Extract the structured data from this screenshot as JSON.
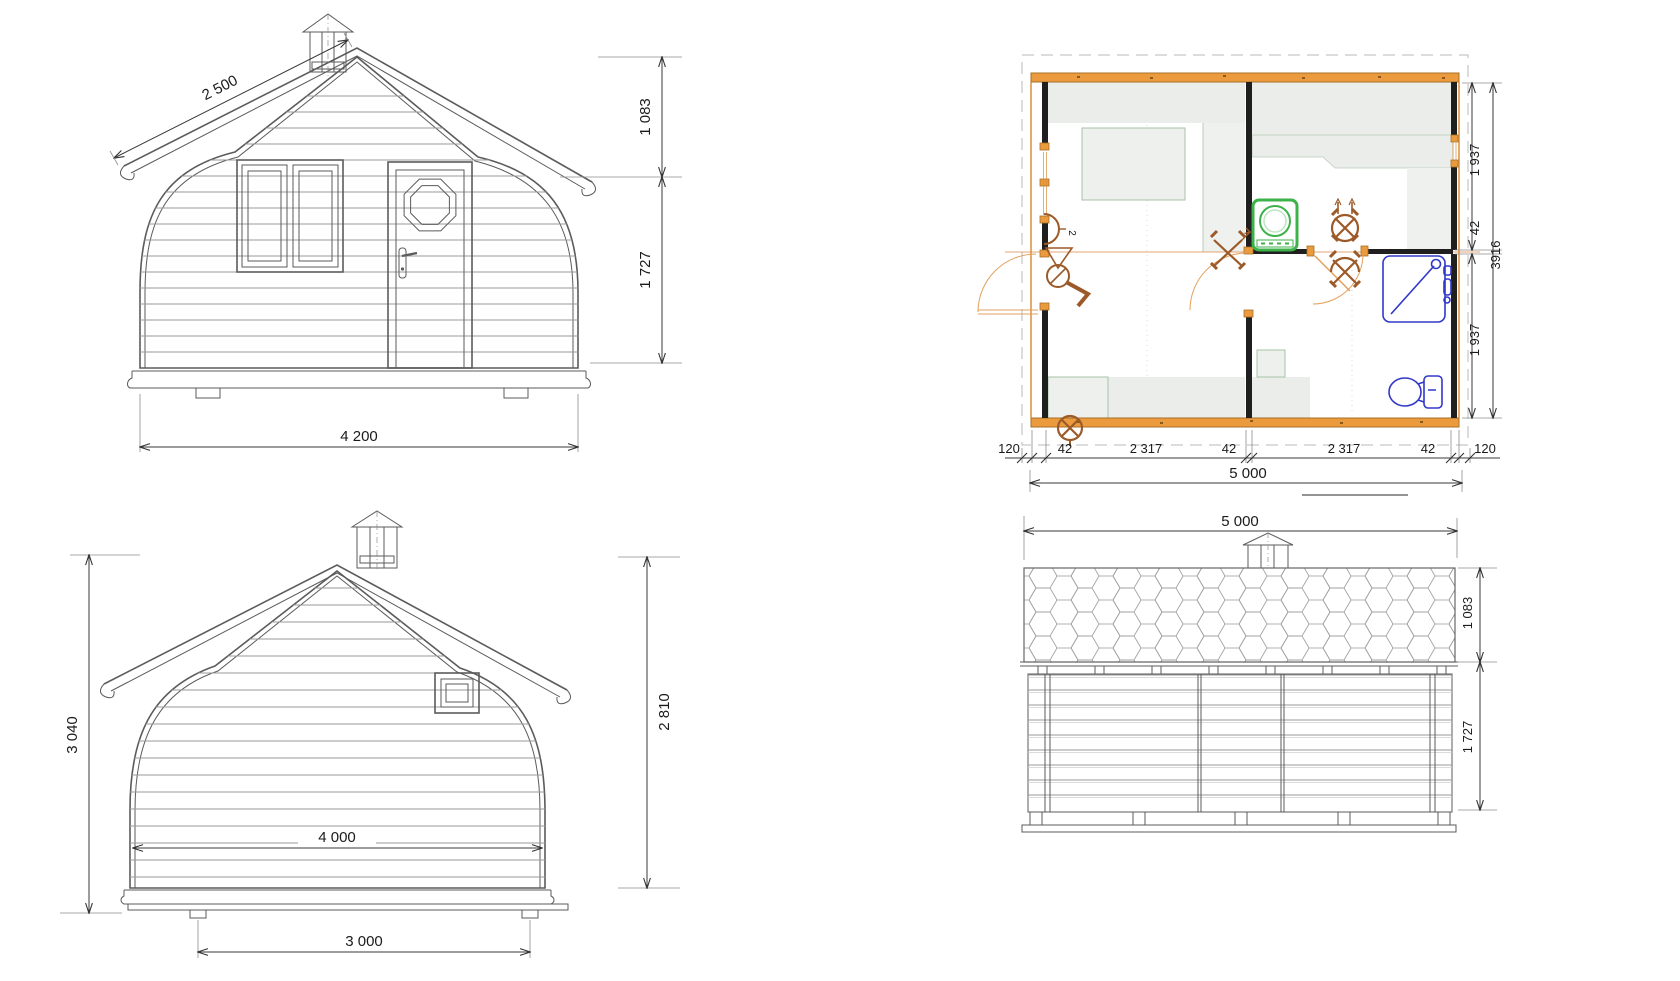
{
  "drawing": {
    "type": "cabin four-view technical drawing",
    "front_elevation": {
      "dim_roof_slope": "2 500",
      "dim_roof_height": "1 083",
      "dim_wall_height": "1 727",
      "dim_overall_width": "4 200"
    },
    "floor_plan": {
      "dims_bottom": [
        "120",
        "42",
        "2 317",
        "42",
        "2 317",
        "42",
        "120"
      ],
      "dim_total_length": "5 000",
      "dims_right": [
        "1 937",
        "42",
        "1 937"
      ],
      "dim_total_depth": "3916",
      "switch_label": "2"
    },
    "rear_elevation": {
      "dim_total_height": "3 040",
      "dim_ridge_height": "2 810",
      "dim_inner_width": "4 000",
      "dim_base_width": "3 000"
    },
    "side_elevation": {
      "dim_length": "5 000",
      "dim_roof_height": "1 083",
      "dim_wall_height": "1 727"
    },
    "colors": {
      "wall_orange": "#eb9a3e",
      "fixture_blue": "#3038c8",
      "appliance_green": "#3db24a",
      "symbol_brown": "#9c5a28",
      "line_gray": "#5b5b5b"
    }
  }
}
